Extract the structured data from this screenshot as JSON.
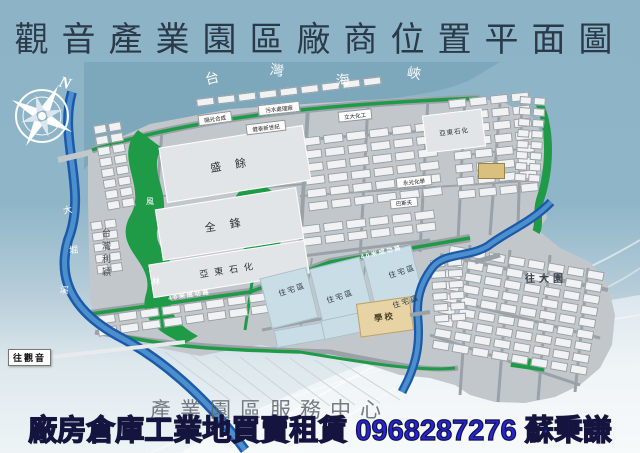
{
  "title": "觀音產業園區廠商位置平面圖",
  "banner": {
    "text": "廠房倉庫工業地買賣租賃 0968287276 蘇秉謙"
  },
  "watermark": {
    "text": "產業園區服務中心"
  },
  "scale_note": "1:5,000",
  "compass": {
    "north_label": "N"
  },
  "directions": {
    "to_guanyin": "往觀音",
    "to_dayuan": "往大園"
  },
  "sea": {
    "name": "台灣海峽",
    "chars": [
      {
        "c": "台",
        "x": 205,
        "y": 68,
        "r": -14
      },
      {
        "c": "灣",
        "x": 270,
        "y": 60,
        "r": 8
      },
      {
        "c": "海",
        "x": 336,
        "y": 70,
        "r": -6
      },
      {
        "c": "峽",
        "x": 407,
        "y": 63,
        "r": 10
      }
    ]
  },
  "rivers": [
    {
      "name": "大堀溪",
      "chars": [
        {
          "c": "大",
          "x": 63,
          "y": 203,
          "r": -12
        },
        {
          "c": "堀",
          "x": 69,
          "y": 243,
          "r": -5
        },
        {
          "c": "溪",
          "x": 60,
          "y": 283,
          "r": 8
        }
      ]
    }
  ],
  "colors": {
    "sea": "#7da8bc",
    "land": "#c2c7cb",
    "road": "#9aa2a8",
    "green": "#1f9b48",
    "river_dark": "#1a5aa8",
    "river_light": "#4d8fcc",
    "big_block": "#e2e5e7",
    "residential": "#c9dde7",
    "school": "#e7d3a4",
    "banner_text": "#2424d8",
    "title_text": "#2b3a49"
  },
  "map": {
    "major_blocks": [
      {
        "t": "盛餘",
        "x": 162,
        "y": 136,
        "w": 146,
        "h": 56,
        "r": -9,
        "fs": 11,
        "ls": 14
      },
      {
        "t": "全鋒",
        "x": 158,
        "y": 198,
        "w": 143,
        "h": 52,
        "r": -9,
        "fs": 11,
        "ls": 14
      },
      {
        "t": "亞東石化",
        "x": 150,
        "y": 252,
        "w": 158,
        "h": 34,
        "r": -9,
        "fs": 9,
        "ls": 6
      },
      {
        "t": "亞東石化",
        "x": 424,
        "y": 112,
        "w": 60,
        "h": 38,
        "r": -7,
        "fs": 6.5,
        "ls": 1
      }
    ],
    "company_strip": {
      "t": "台灣利穎",
      "x": 100,
      "y": 228,
      "fs": 9
    },
    "green_labels": [
      {
        "c": "風",
        "x": 146,
        "y": 196
      },
      {
        "c": "林",
        "x": 152,
        "y": 276
      }
    ],
    "factories": [
      {
        "t": "污水處理廠",
        "x": 258,
        "y": 103,
        "w": 42,
        "h": 11,
        "r": -6
      },
      {
        "t": "陽光合成",
        "x": 198,
        "y": 113,
        "w": 34,
        "h": 11,
        "r": -8
      },
      {
        "t": "健泰新世紀",
        "x": 246,
        "y": 122,
        "w": 40,
        "h": 11,
        "r": -7
      },
      {
        "t": "立大化工",
        "x": 338,
        "y": 110,
        "w": 34,
        "h": 11,
        "r": -6
      },
      {
        "t": "永光化學",
        "x": 396,
        "y": 176,
        "w": 36,
        "h": 11,
        "r": -6
      },
      {
        "t": "巴斯夫",
        "x": 390,
        "y": 198,
        "w": 28,
        "h": 10,
        "r": -6
      }
    ],
    "road_labels": [
      {
        "t": "40米成功路",
        "x": 168,
        "y": 290,
        "r": -9
      },
      {
        "t": "40米成功路",
        "x": 360,
        "y": 247,
        "r": -13
      }
    ],
    "residential": {
      "label": "住宅區",
      "blocks": [
        {
          "x": 265,
          "y": 272,
          "w": 48,
          "h": 52,
          "r": -14
        },
        {
          "x": 315,
          "y": 262,
          "w": 52,
          "h": 55,
          "r": -14
        },
        {
          "x": 368,
          "y": 250,
          "w": 50,
          "h": 52,
          "r": -14
        },
        {
          "x": 275,
          "y": 326,
          "w": 50,
          "h": 18,
          "r": -10
        },
        {
          "x": 322,
          "y": 316,
          "w": 42,
          "h": 20,
          "r": -12
        }
      ],
      "labels": [
        {
          "x": 278,
          "y": 284
        },
        {
          "x": 326,
          "y": 291
        },
        {
          "x": 388,
          "y": 266
        },
        {
          "x": 392,
          "y": 296
        }
      ]
    },
    "school": {
      "label": "學校",
      "x": 358,
      "y": 300,
      "w": 54,
      "h": 34,
      "r": -8
    },
    "service_building": {
      "x": 478,
      "y": 163,
      "w": 27,
      "h": 16
    },
    "clusters": [
      {
        "x": 93,
        "y": 126,
        "r": -10,
        "cols": 2,
        "rows": 8,
        "cw": 13,
        "ch": 9,
        "gx": 2,
        "gy": 2
      },
      {
        "x": 90,
        "y": 222,
        "r": -8,
        "cols": 2,
        "rows": 5,
        "cw": 12,
        "ch": 9,
        "gx": 2,
        "gy": 2
      },
      {
        "x": 196,
        "y": 99,
        "r": -7,
        "cols": 9,
        "rows": 1,
        "cw": 18,
        "ch": 8,
        "gx": 3,
        "gy": 2
      },
      {
        "x": 300,
        "y": 138,
        "r": -7,
        "cols": 6,
        "rows": 6,
        "cw": 20,
        "ch": 9,
        "gx": 3,
        "gy": 4
      },
      {
        "x": 300,
        "y": 226,
        "r": -7,
        "cols": 6,
        "rows": 2,
        "cw": 20,
        "ch": 9,
        "gx": 3,
        "gy": 3
      },
      {
        "x": 448,
        "y": 100,
        "r": -6,
        "cols": 4,
        "rows": 8,
        "cw": 18,
        "ch": 9,
        "gx": 3,
        "gy": 4
      },
      {
        "x": 96,
        "y": 316,
        "r": -8,
        "cols": 8,
        "rows": 2,
        "cw": 19,
        "ch": 9,
        "gx": 3,
        "gy": 3
      },
      {
        "x": 450,
        "y": 245,
        "r": 10,
        "cols": 8,
        "rows": 9,
        "cw": 17,
        "ch": 9,
        "gx": 3,
        "gy": 3
      },
      {
        "x": 520,
        "y": 96,
        "r": 4,
        "cols": 2,
        "rows": 8,
        "cw": 12,
        "ch": 8,
        "gx": 2,
        "gy": 3
      },
      {
        "x": 430,
        "y": 260,
        "r": -4,
        "cols": 2,
        "rows": 6,
        "cw": 15,
        "ch": 8,
        "gx": 2,
        "gy": 3
      }
    ]
  }
}
